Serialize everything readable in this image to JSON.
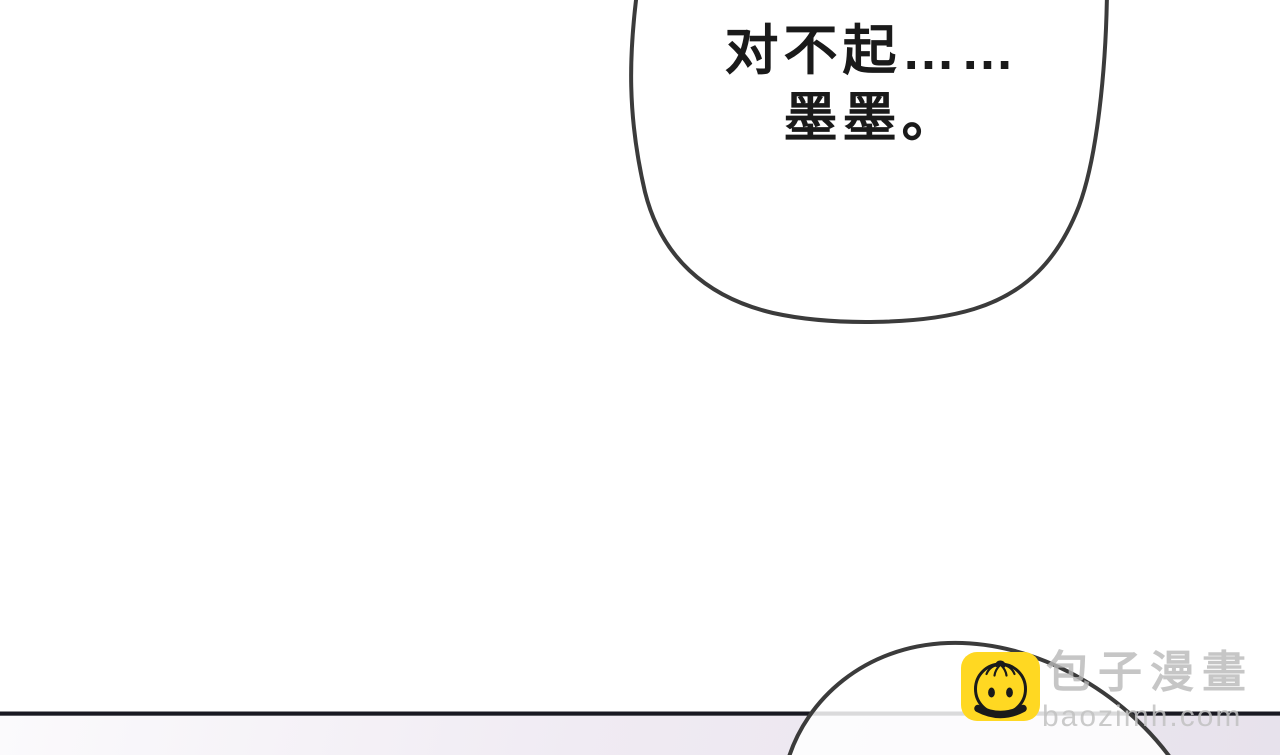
{
  "page": {
    "background_color": "#ffffff",
    "divider_color": "#191922",
    "bottom_tint_start": "#fbfafc",
    "bottom_tint_end": "#e7e2ec"
  },
  "bubbles": {
    "top": {
      "text_line1": "对不起……",
      "text_line2": "墨墨。",
      "text_color": "#1a1a1a",
      "fill": "#ffffff",
      "stroke": "#3b3b3b"
    },
    "bottom": {
      "fill": "rgba(255,255,255,0.84)",
      "stroke": "#3b3b3b"
    }
  },
  "watermark": {
    "brand_text": "包子漫畫",
    "domain_text": "baozimh.com",
    "brand_color": "#b9b9b9",
    "domain_color": "#c2c2c2",
    "icon_name": "baozi-bun-icon",
    "icon_background": "#ffd822",
    "icon_ink": "#1a1a1a"
  }
}
